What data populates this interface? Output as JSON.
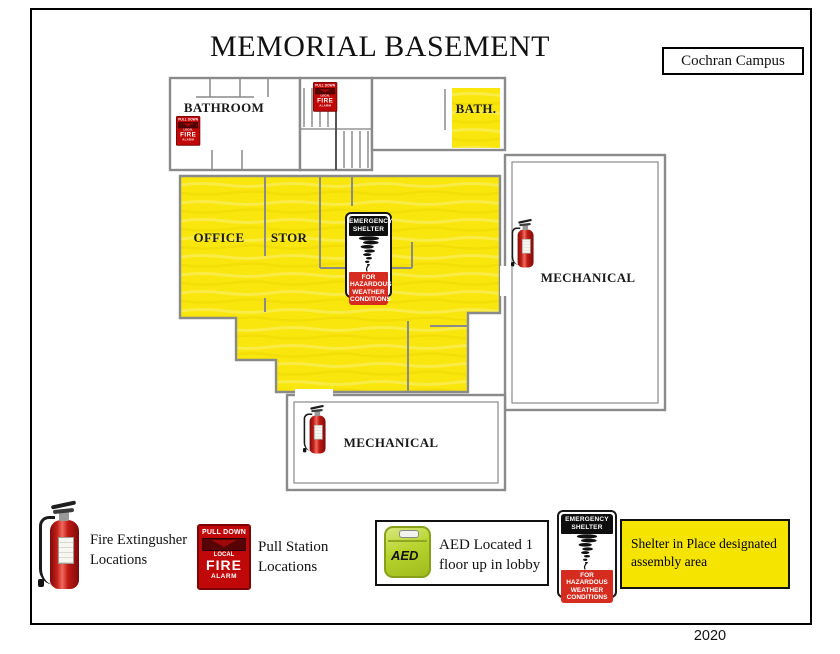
{
  "header": {
    "title": "MEMORIAL BASEMENT",
    "campus": "Cochran Campus"
  },
  "footer": {
    "year": "2020"
  },
  "rooms": {
    "bathroom": "BATHROOM",
    "bath": "BATH.",
    "office": "OFFICE",
    "storage": "STOR",
    "mechanical": "MECHANICAL"
  },
  "shelter_sign": {
    "header": "EMERGENCY SHELTER",
    "footer": "FOR HAZARDOUS WEATHER CONDITIONS"
  },
  "pull_station_sign": {
    "top": "PULL DOWN",
    "local": "LOCAL",
    "fire": "FIRE",
    "alarm": "ALARM"
  },
  "aed": {
    "device_label": "AED"
  },
  "legend": {
    "fire_extinguisher": "Fire Extingusher Locations",
    "pull_station": "Pull Station Locations",
    "aed_note": "AED Located 1 floor up in lobby",
    "shelter_note": "Shelter in Place designated assembly area"
  },
  "colors": {
    "highlight_yellow": "#F8E60D",
    "alarm_red": "#C00808",
    "sign_red": "#D62B1F",
    "aed_green": "#B8D32E",
    "wall_gray": "#8A8A8A"
  }
}
